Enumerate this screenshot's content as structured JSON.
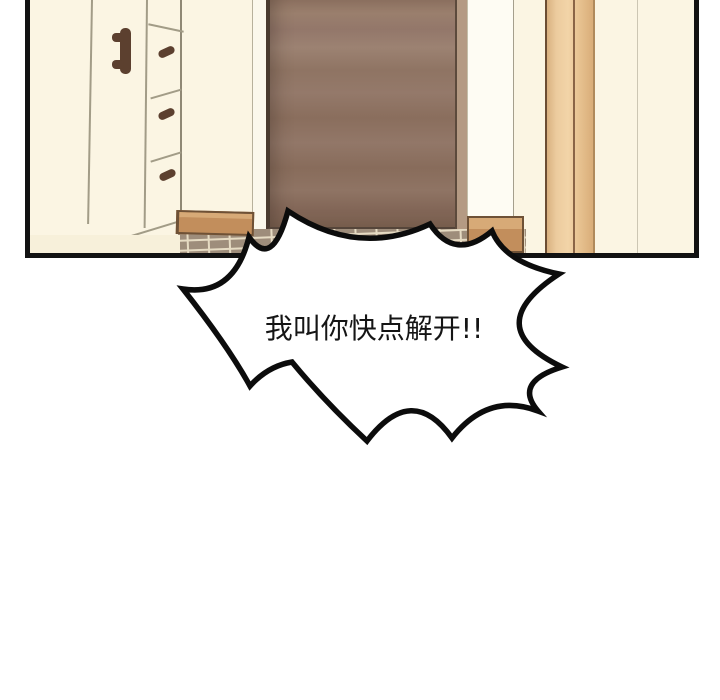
{
  "panel": {
    "description_label": "entryway-scene"
  },
  "bubble": {
    "text": "我叫你快点解开!!"
  },
  "palette": {
    "panel_outline": "#121212",
    "wall_cream": "#fbf5e3",
    "door_brown": "#8f7463",
    "door_edge_light": "#b49a83",
    "door_frame_tan": "#eccb9e",
    "wood_step": "#c28e5c",
    "step_top": "#d7aa77",
    "tile": "#9e8d7b",
    "tile_grout": "#e6dbc3",
    "handle_brown": "#5c402f",
    "bubble_fill": "#ffffff",
    "bubble_stroke": "#0c0c0c",
    "text_color": "#151515"
  }
}
